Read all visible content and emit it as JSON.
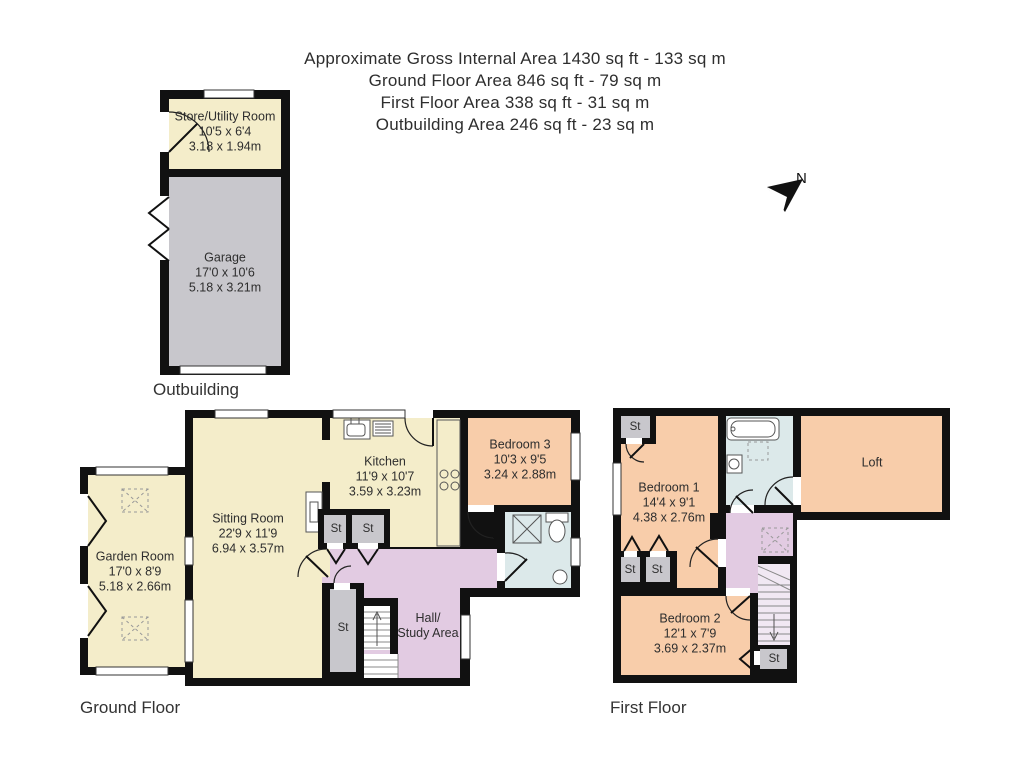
{
  "header": {
    "lines": [
      "Approximate Gross Internal Area 1430 sq ft - 133 sq m",
      "Ground Floor Area 846 sq ft - 79 sq m",
      "First Floor Area 338 sq ft - 31 sq m",
      "Outbuilding Area 246 sq ft - 23 sq m"
    ]
  },
  "compass": {
    "label": "N"
  },
  "labels": {
    "st": "St"
  },
  "colors": {
    "cream": "#f4edca",
    "peach": "#f8cdaa",
    "lavender": "#e2cbe2",
    "blue": "#dce9ea",
    "gray": "#c8c7cc",
    "wall": "#111111"
  },
  "floors": {
    "outbuilding": {
      "label": "Outbuilding",
      "rooms": {
        "store": {
          "name": "Store/Utility Room",
          "imperial": "10'5 x 6'4",
          "metric": "3.18 x 1.94m"
        },
        "garage": {
          "name": "Garage",
          "imperial": "17'0 x 10'6",
          "metric": "5.18 x 3.21m"
        }
      }
    },
    "ground": {
      "label": "Ground Floor",
      "rooms": {
        "garden": {
          "name": "Garden Room",
          "imperial": "17'0 x 8'9",
          "metric": "5.18 x 2.66m"
        },
        "sitting": {
          "name": "Sitting Room",
          "imperial": "22'9 x 11'9",
          "metric": "6.94 x 3.57m"
        },
        "kitchen": {
          "name": "Kitchen",
          "imperial": "11'9 x 10'7",
          "metric": "3.59 x 3.23m"
        },
        "bedroom3": {
          "name": "Bedroom 3",
          "imperial": "10'3 x 9'5",
          "metric": "3.24 x 2.88m"
        },
        "hall": {
          "name_line1": "Hall/",
          "name_line2": "Study Area"
        }
      }
    },
    "first": {
      "label": "First Floor",
      "rooms": {
        "bedroom1": {
          "name": "Bedroom 1",
          "imperial": "14'4 x 9'1",
          "metric": "4.38 x 2.76m"
        },
        "bedroom2": {
          "name": "Bedroom 2",
          "imperial": "12'1 x 7'9",
          "metric": "3.69 x 2.37m"
        },
        "loft": {
          "name": "Loft"
        }
      }
    }
  }
}
